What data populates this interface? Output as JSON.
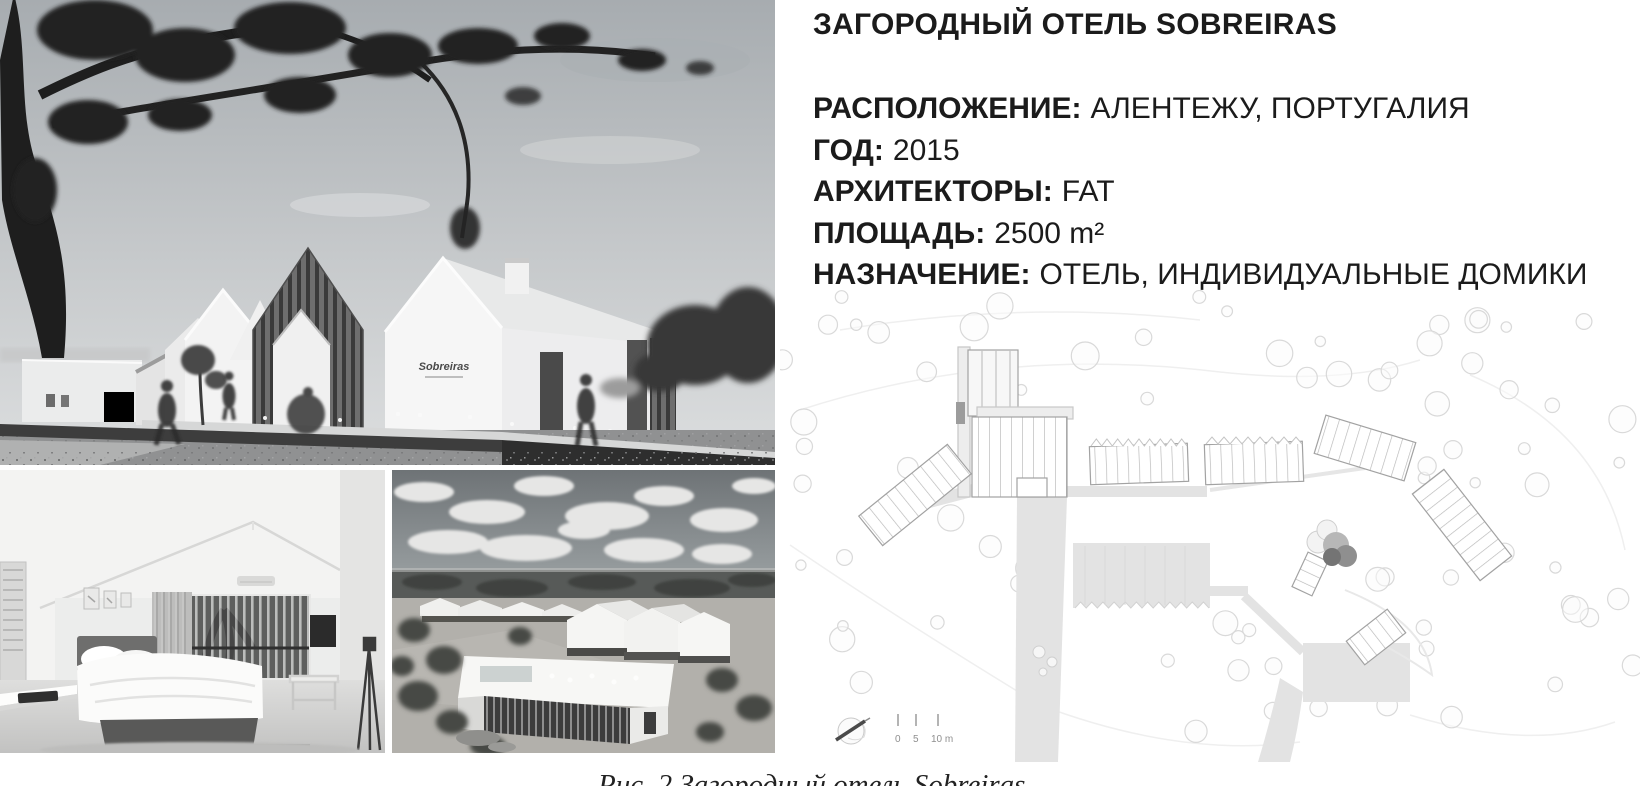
{
  "page": {
    "background": "#ffffff"
  },
  "info": {
    "title": "ЗАГОРОДНЫЙ ОТЕЛЬ SOBREIRAS",
    "fields": [
      {
        "label": "РАСПОЛОЖЕНИЕ:",
        "value": "АЛЕНТЕЖУ, ПОРТУГАЛИЯ"
      },
      {
        "label": "ГОД:",
        "value": "2015"
      },
      {
        "label": "АРХИТЕКТОРЫ:",
        "value": "FAT"
      },
      {
        "label": "ПЛОЩАДЬ:",
        "value": "2500 m²"
      },
      {
        "label": "НАЗНАЧЕНИЕ:",
        "value": "ОТЕЛЬ, ИНДИВИДУАЛЬНЫЕ ДОМИКИ"
      }
    ]
  },
  "photos": {
    "main_sign": "Sobreiras"
  },
  "site_plan": {
    "scale_labels": {
      "zero": "0",
      "five": "5",
      "ten": "10 m"
    },
    "colors": {
      "line": "#c9c9c9",
      "fill": "#e3e3e3"
    }
  },
  "caption": {
    "figure_text": "Рис. 2 Загородный отель Sobreiras"
  }
}
